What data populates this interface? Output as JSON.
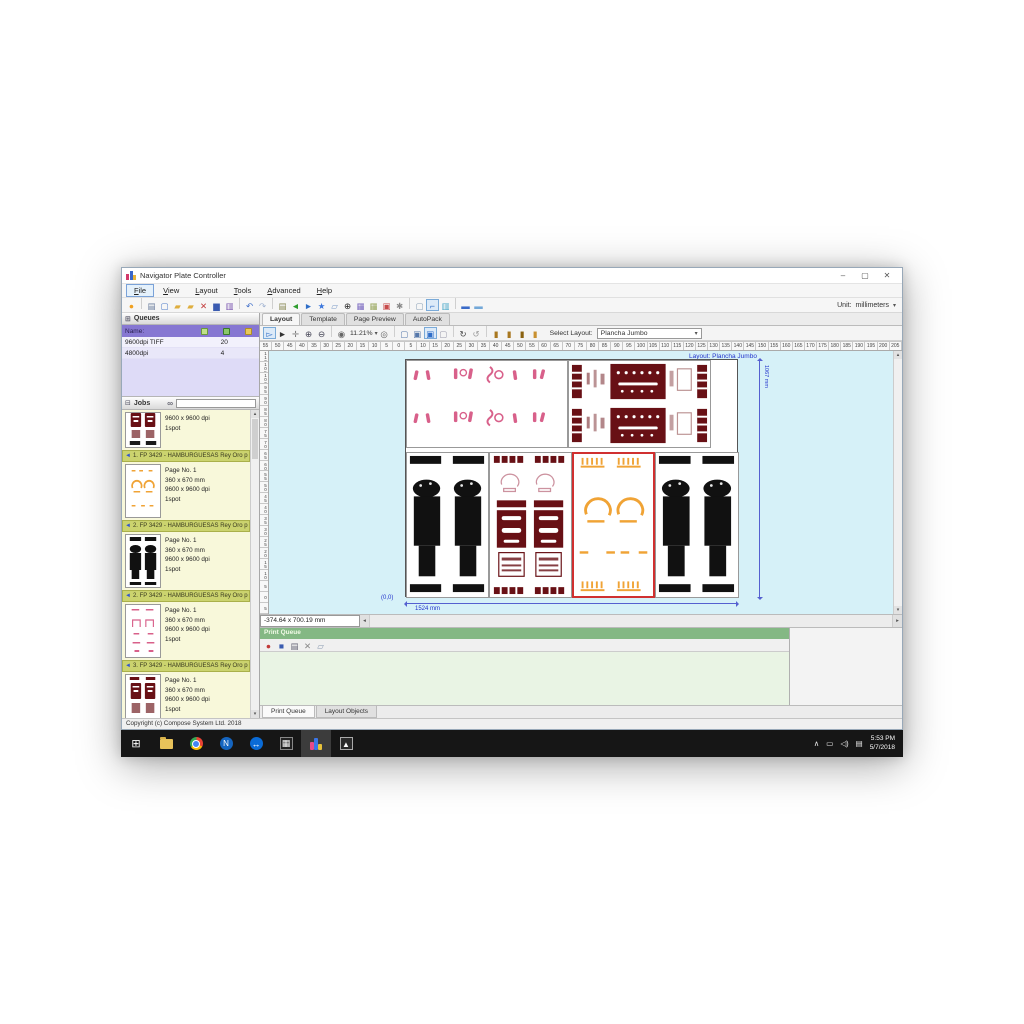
{
  "window": {
    "title": "Navigator Plate Controller",
    "minimize": "–",
    "maximize": "▢",
    "close": "✕"
  },
  "menu": {
    "items": [
      "File",
      "View",
      "Layout",
      "Tools",
      "Advanced",
      "Help"
    ]
  },
  "unit": {
    "label": "Unit:",
    "value": "millimeters"
  },
  "toolbar_main": {
    "icons": [
      "record",
      "sep",
      "print-setup",
      "new-page",
      "open-folder",
      "folder",
      "delete",
      "save",
      "library",
      "sep",
      "undo",
      "redo",
      "sep",
      "print",
      "export",
      "import",
      "favorite",
      "paste",
      "center",
      "grid-purple",
      "grid-green",
      "alert",
      "settings",
      "sep",
      "page",
      "ruler-corner",
      "chart",
      "sep",
      "panel-blue",
      "panel-light"
    ]
  },
  "queues": {
    "title": "Queues",
    "name_col": "Name:",
    "header_icons": [
      "page-icon",
      "check-folder-icon",
      "folder-icon"
    ],
    "rows": [
      {
        "name": "9600dpi TIFF",
        "count": "20"
      },
      {
        "name": "4800dpi",
        "count": "4"
      }
    ]
  },
  "jobs": {
    "title": "Jobs",
    "partial": {
      "details": [
        "9600 x 9600 dpi",
        "1spot"
      ]
    },
    "items": [
      {
        "header": "1. FP 3429 - HAMBURGUESAS Rey Oro p",
        "thumb": "orange",
        "details": [
          "Page No. 1",
          "360 x 670 mm",
          "9600 x 9600 dpi",
          "1spot"
        ]
      },
      {
        "header": "2. FP 3429 - HAMBURGUESAS Rey Oro p",
        "thumb": "black",
        "details": [
          "Page No. 1",
          "360 x 670 mm",
          "9600 x 9600 dpi",
          "1spot"
        ]
      },
      {
        "header": "2. FP 3429 - HAMBURGUESAS Rey Oro p",
        "thumb": "pink",
        "details": [
          "Page No. 1",
          "360 x 670 mm",
          "9600 x 9600 dpi",
          "1spot"
        ]
      },
      {
        "header": "3. FP 3429 - HAMBURGUESAS Rey Oro p",
        "thumb": "darkred",
        "details": [
          "Page No. 1",
          "360 x 670 mm",
          "9600 x 9600 dpi",
          "1spot"
        ]
      }
    ]
  },
  "view_tabs": {
    "items": [
      "Layout",
      "Template",
      "Page Preview",
      "AutoPack"
    ],
    "active": "Layout"
  },
  "toolbar_layout": {
    "icons_left": [
      "select-tool",
      "pointer",
      "pan-hand",
      "zoom-in",
      "zoom-out",
      "sep",
      "fit-view"
    ],
    "zoom": "11.21%",
    "icons_mid": [
      "target",
      "sep",
      "page-new",
      "page-grid",
      "page-marked",
      "page-plain",
      "sep",
      "rotate",
      "flip",
      "sep",
      "gold-mark1",
      "gold-mark2",
      "gold-mark3",
      "gold-mark4"
    ],
    "select_label": "Select Layout:",
    "select_value": "Plancha Jumbo"
  },
  "rulers": {
    "h": [
      "55",
      "50",
      "45",
      "40",
      "35",
      "30",
      "25",
      "20",
      "15",
      "10",
      "5",
      "0",
      "5",
      "10",
      "15",
      "20",
      "25",
      "30",
      "35",
      "40",
      "45",
      "50",
      "55",
      "60",
      "65",
      "70",
      "75",
      "80",
      "85",
      "90",
      "95",
      "100",
      "105",
      "110",
      "115",
      "120",
      "125",
      "130",
      "135",
      "140",
      "145",
      "150",
      "155",
      "160",
      "165",
      "170",
      "175",
      "180",
      "185",
      "190",
      "195",
      "200",
      "205"
    ],
    "v": [
      "110",
      "105",
      "100",
      "95",
      "90",
      "85",
      "80",
      "75",
      "70",
      "65",
      "60",
      "55",
      "50",
      "45",
      "40",
      "35",
      "30",
      "25",
      "20",
      "15",
      "10",
      "5",
      "0",
      "5"
    ]
  },
  "canvas": {
    "label": "Layout: Plancha Jumbo",
    "origin": "(0,0)",
    "width_dim": "1524 mm",
    "height_dim": "1067 mm"
  },
  "status": {
    "coords": "-374.64 x 700.19 mm",
    "copyright": "Copyright (c) Compose System Ltd. 2018"
  },
  "print_queue": {
    "title": "Print Queue",
    "icons": [
      "pq-pause",
      "pq-stop",
      "pq-print",
      "pq-delete",
      "pq-copy"
    ],
    "tabs": [
      "Print Queue",
      "Layout Objects"
    ],
    "active_tab": "Print Queue"
  },
  "taskbar": {
    "time": "5:53 PM",
    "date": "5/7/2018"
  }
}
